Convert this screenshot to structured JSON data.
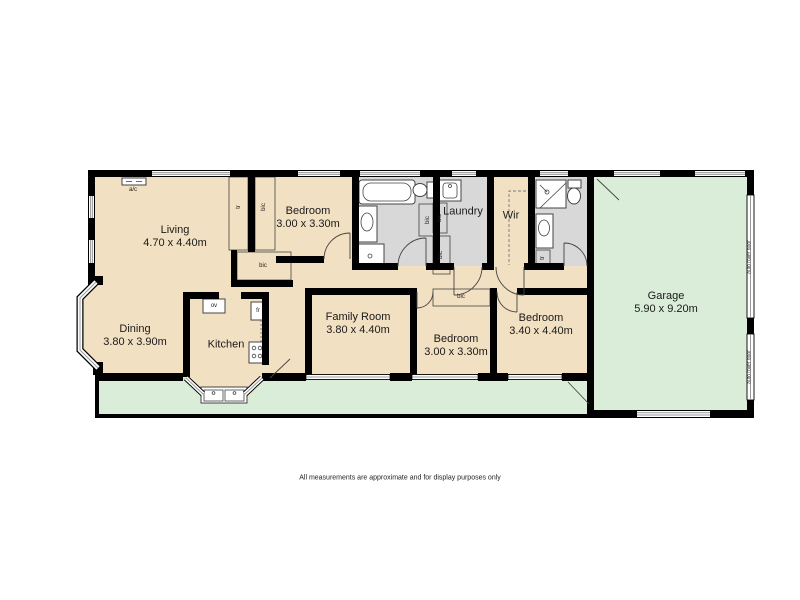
{
  "floorplan": {
    "rooms": {
      "living": {
        "name": "Living",
        "dims": "4.70 x 4.40m"
      },
      "bedroom_top": {
        "name": "Bedroom",
        "dims": "3.00 x 3.30m"
      },
      "laundry": {
        "name": "Laundry"
      },
      "wir": {
        "name": "Wir"
      },
      "garage": {
        "name": "Garage",
        "dims": "5.90 x 9.20m"
      },
      "dining": {
        "name": "Dining",
        "dims": "3.80 x 3.90m"
      },
      "kitchen": {
        "name": "Kitchen"
      },
      "family_room": {
        "name": "Family Room",
        "dims": "3.80 x 4.40m"
      },
      "bedroom_mid": {
        "name": "Bedroom",
        "dims": "3.00 x 3.30m"
      },
      "bedroom_right": {
        "name": "Bedroom",
        "dims": "3.40 x 4.40m"
      }
    },
    "labels": {
      "ac": "a/c",
      "ov": "ov",
      "fr": "fr",
      "bic": "bic",
      "tr": "tr",
      "auto_roller_door": "auto roller door"
    },
    "colors": {
      "wall": "#000000",
      "floor": "#f2e0c2",
      "wet_area": "#d8d8d8",
      "outdoor": "#d9edd9"
    },
    "disclaimer": "All measurements are approximate and for display purposes only"
  }
}
